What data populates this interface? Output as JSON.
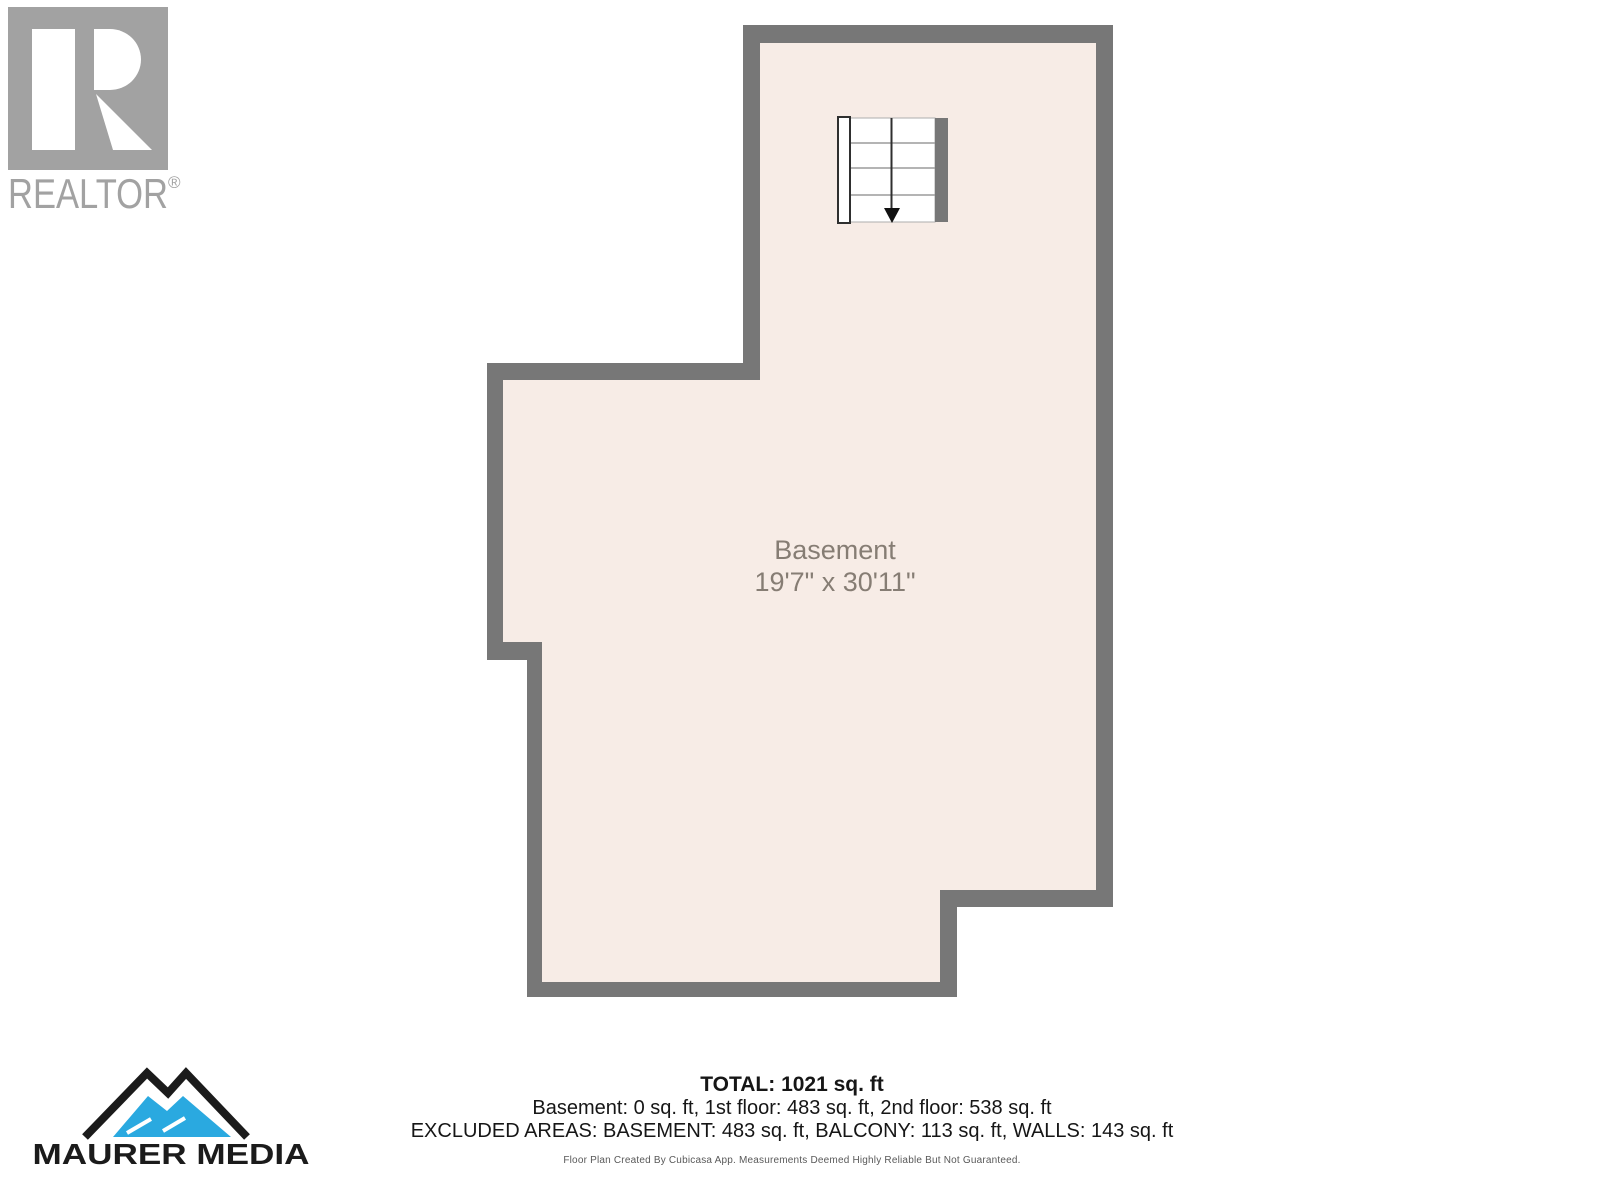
{
  "realtor_logo": {
    "wordmark": "REALTOR",
    "registered_mark": "®",
    "color": "#a2a2a2"
  },
  "maurer_logo": {
    "wordmark": "MAURER MEDIA",
    "mountain_blue": "#2aa9e0",
    "mountain_black": "#1b1b1b"
  },
  "floor_plan": {
    "room_label": "Basement",
    "room_dimensions": "19'7\" x 30'11\"",
    "wall_color": "#777777",
    "floor_color": "#f7ece6",
    "stair_arrow_direction": "down"
  },
  "summary": {
    "total": "TOTAL: 1021 sq. ft",
    "floor_breakdown": "Basement: 0 sq. ft, 1st floor: 483 sq. ft, 2nd floor: 538 sq. ft",
    "excluded_areas": "EXCLUDED AREAS: BASEMENT: 483 sq. ft, BALCONY: 113 sq. ft, WALLS: 143 sq. ft",
    "disclaimer": "Floor Plan Created By Cubicasa App. Measurements Deemed Highly Reliable But Not Guaranteed."
  }
}
